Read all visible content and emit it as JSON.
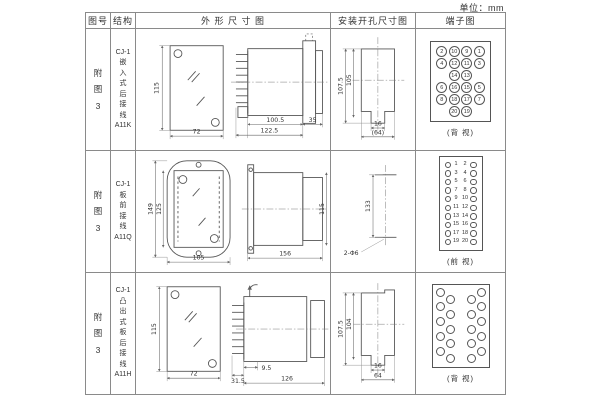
{
  "unit_label": "单位：mm",
  "headers": {
    "col1": "图号",
    "col2": "结构",
    "col3": "外 形 尺 寸 图",
    "col4": "安装开孔尺寸图",
    "col5": "端子图"
  },
  "rows": [
    {
      "figure_no": "附\n图\n3",
      "structure": "CJ-1\n嵌\n入\n式\n后\n接\n线\nA11K",
      "outline": {
        "dims": {
          "h": "115",
          "w": "72",
          "l1": "100.5",
          "l2": "122.5",
          "l3": "35"
        }
      },
      "install": {
        "dims": {
          "v1": "107.5",
          "v2": "105",
          "h1": "16",
          "h2": "(64)"
        }
      },
      "terminal": {
        "type": "grid4",
        "view_label": "(背 视)",
        "cells": [
          [
            "2",
            "10",
            "9",
            "1"
          ],
          [
            "4",
            "12",
            "11",
            "3"
          ],
          [
            "",
            "14",
            "13",
            ""
          ],
          [
            "6",
            "16",
            "15",
            "5"
          ],
          [
            "8",
            "18",
            "17",
            "7"
          ],
          [
            "",
            "20",
            "19",
            ""
          ]
        ]
      }
    },
    {
      "figure_no": "附\n图\n3",
      "structure": "CJ-1\n板\n前\n接\n线\nA11Q",
      "outline": {
        "dims": {
          "h1": "149",
          "h2": "125",
          "w": "105",
          "l": "156",
          "h3": "115"
        }
      },
      "install": {
        "dims": {
          "v": "133",
          "hole": "2-Φ6"
        }
      },
      "terminal": {
        "type": "pairs",
        "view_label": "(前 视)",
        "pairs": [
          [
            "1",
            "2"
          ],
          [
            "3",
            "4"
          ],
          [
            "5",
            "6"
          ],
          [
            "7",
            "8"
          ],
          [
            "9",
            "10"
          ],
          [
            "11",
            "12"
          ],
          [
            "13",
            "14"
          ],
          [
            "15",
            "16"
          ],
          [
            "17",
            "18"
          ],
          [
            "19",
            "20"
          ]
        ]
      }
    },
    {
      "figure_no": "附\n图\n3",
      "structure": "CJ-1\n凸\n出\n式\n板\n后\n接\n线\nA11H",
      "outline": {
        "dims": {
          "h": "115",
          "w": "72",
          "l1": "31.5",
          "l2": "9.5",
          "l3": "126"
        }
      },
      "install": {
        "dims": {
          "v1": "107.5",
          "v2": "104",
          "h1": "16",
          "h2": "64"
        }
      },
      "terminal": {
        "type": "zigzag",
        "view_label": "(背 视)",
        "count": 20
      }
    }
  ]
}
